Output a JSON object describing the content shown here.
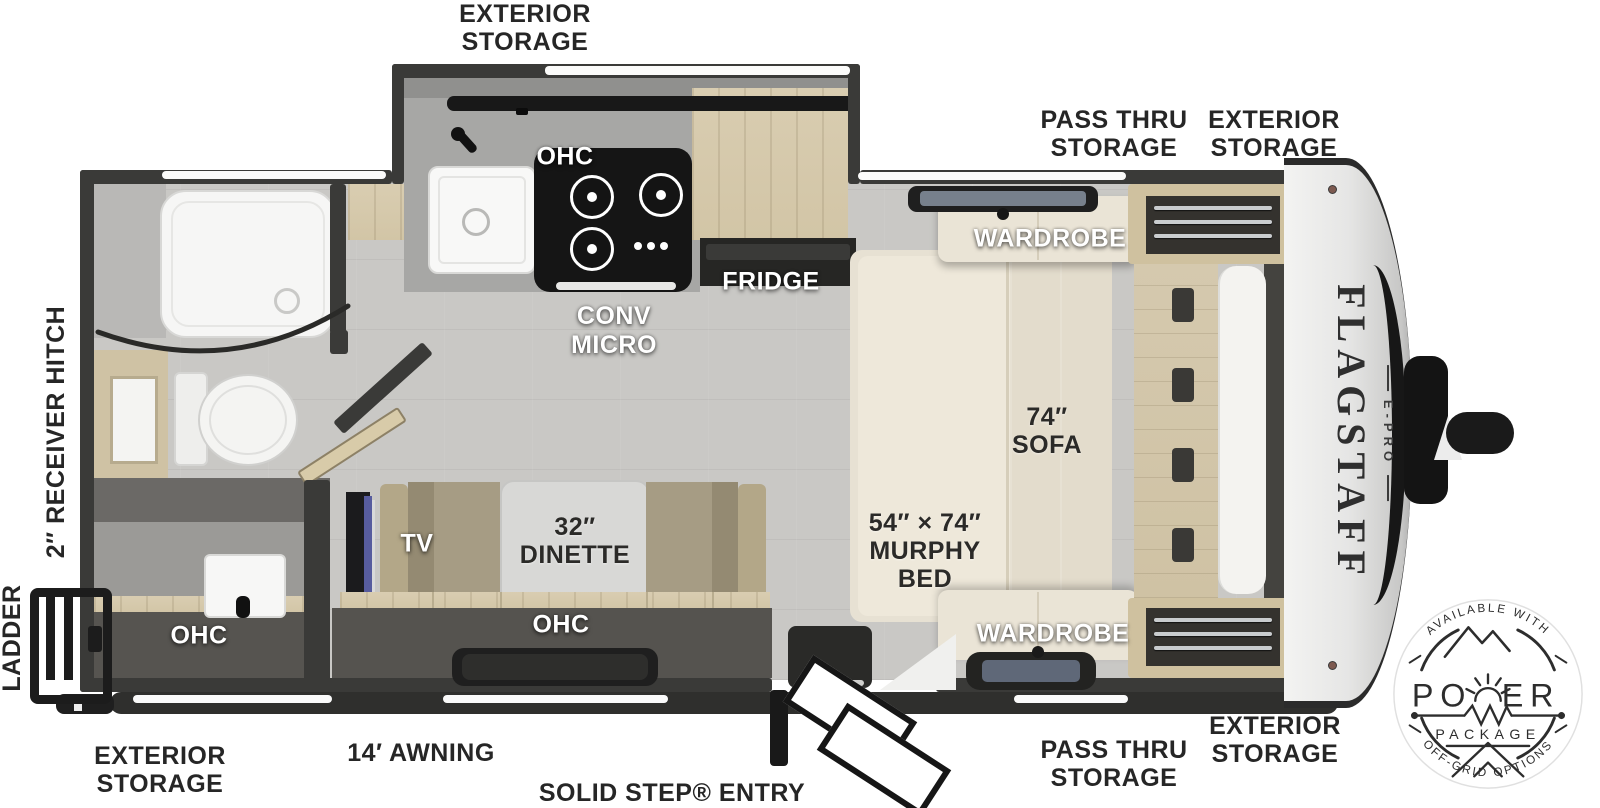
{
  "colors": {
    "ink": "#262626",
    "wall": "#3a3a38",
    "floor": "#c9c8c5",
    "wood": "#d7cbae",
    "cream": "#eae4d6",
    "counter": "#a7a7a5",
    "tv_accent": "#575c9e",
    "badge_ink": "#2d2d2d"
  },
  "labels": {
    "storage_top": "EXTERIOR\nSTORAGE",
    "pass_thru_top": "PASS THRU\nSTORAGE",
    "storage_front_top": "EXTERIOR\nSTORAGE",
    "receiver_hitch": "2″ RECEIVER HITCH",
    "ladder": "LADDER",
    "storage_rear_bottom": "EXTERIOR\nSTORAGE",
    "awning": "14′ AWNING",
    "entry": "SOLID STEP® ENTRY",
    "pass_thru_bottom": "PASS THRU\nSTORAGE",
    "storage_front_bottom": "EXTERIOR\nSTORAGE"
  },
  "rooms": {
    "kitchen_ohc": "OHC",
    "conv_micro": "CONV\nMICRO",
    "fridge": "FRIDGE",
    "wardrobe_top": "WARDROBE",
    "sofa": "74″\nSOFA",
    "murphy_bed": "54″ × 74″\nMURPHY\nBED",
    "wardrobe_bottom": "WARDROBE",
    "dinette": "32″\nDINETTE",
    "dinette_ohc": "OHC",
    "tv": "TV",
    "bath_ohc": "OHC"
  },
  "brand": {
    "name": "FLAGSTAFF",
    "sub": "E-PRO"
  },
  "badge": {
    "arc_top": "AVAILABLE WITH",
    "power_left": "PO",
    "power_right": "ER",
    "package": "PACKAGE",
    "arc_bottom": "OFF-GRID OPTIONS"
  }
}
